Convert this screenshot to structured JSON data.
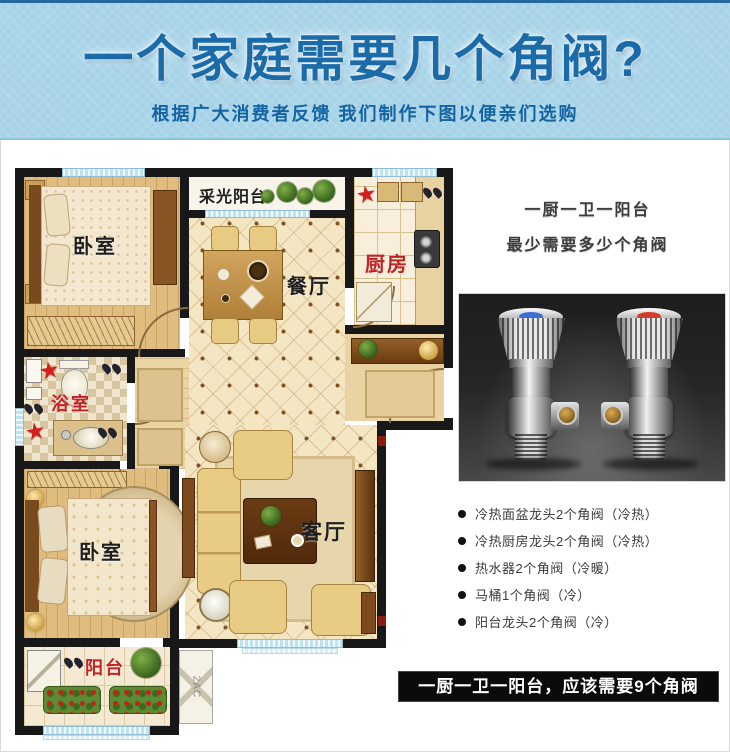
{
  "header": {
    "title": "一个家庭需要几个角阀?",
    "subtitle": "根据广大消费者反馈 我们制作下图以便亲们选购"
  },
  "floor_plan": {
    "rooms": {
      "bedroom_top": "卧室",
      "daylight_balcony": "采光阳台",
      "dining_room": "餐厅",
      "kitchen": "厨房",
      "bathroom": "浴室",
      "living_room": "客厅",
      "bedroom_bottom": "卧室",
      "balcony": "阳台",
      "ac_platform": "2AC"
    },
    "star_glyph": "★",
    "star_color": "#d21f1f",
    "red_label_color": "#c22323"
  },
  "right_panel": {
    "heading_line1": "一厨一卫一阳台",
    "heading_line2": "最少需要多少个角阀",
    "valve_image": {
      "cold_cap_color": "#3c6fd6",
      "hot_cap_color": "#d23a2a"
    },
    "bullets": [
      "冷热面盆龙头2个角阀（冷热）",
      "冷热厨房龙头2个角阀（冷热）",
      "热水器2个角阀（冷暖）",
      "马桶1个角阀（冷）",
      "阳台龙头2个角阀（冷）"
    ],
    "conclusion": "一厨一卫一阳台，应该需要9个角阀"
  }
}
